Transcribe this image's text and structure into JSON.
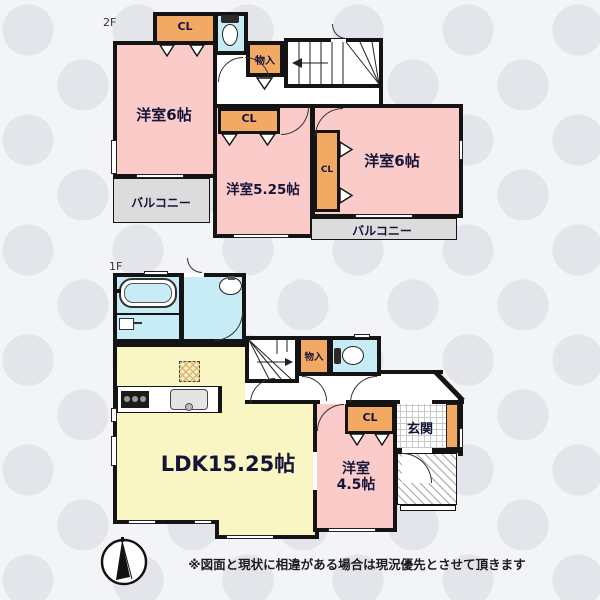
{
  "floor2": {
    "label": "2F",
    "room_west6": "洋室6帖",
    "room_center": "洋室5.25帖",
    "room_east6": "洋室6帖",
    "closet_a": "CL",
    "closet_b": "CL",
    "closet_c": "CL",
    "storage": "物入",
    "balcony_left": "バルコニー",
    "balcony_right": "バルコニー"
  },
  "floor1": {
    "label": "1F",
    "ldk": "LDK15.25帖",
    "room45_line1": "洋室",
    "room45_line2": "4.5帖",
    "closet": "CL",
    "storage": "物入",
    "entrance": "玄関"
  },
  "footer": {
    "disclaimer": "※図面と現状に相違がある場合は現況優先とさせて頂きます"
  },
  "colors": {
    "room_pink": "#facbc9",
    "ldk_yellow": "#faf6c3",
    "wet_cyan": "#c7ecf5",
    "closet_orange": "#f2a963",
    "balcony_gray": "#dcdcdc",
    "wall_black": "#141414"
  }
}
